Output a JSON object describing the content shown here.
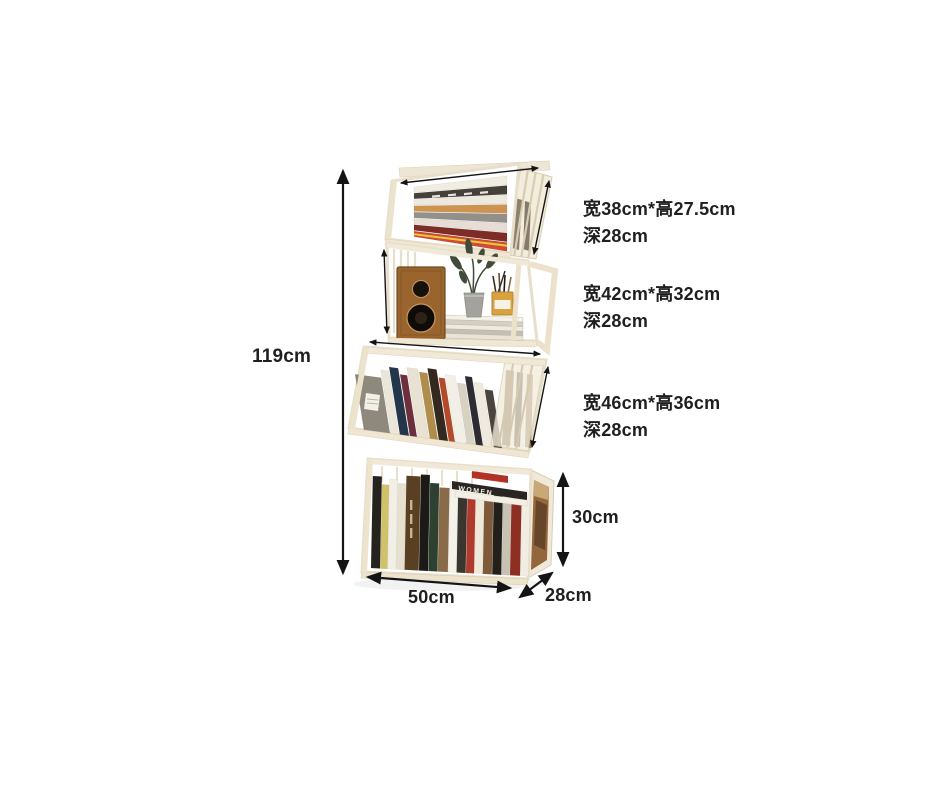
{
  "canvas": {
    "width": 940,
    "height": 788,
    "background": "#ffffff"
  },
  "labels": {
    "total_height": "119cm",
    "base_width": "50cm",
    "base_depth": "28cm",
    "tier4_height": "30cm",
    "tier_specs": [
      {
        "size": "宽38cm*高27.5cm",
        "depth": "深28cm"
      },
      {
        "size": "宽42cm*高32cm",
        "depth": "深28cm"
      },
      {
        "size": "宽46cm*高36cm",
        "depth": "深28cm"
      }
    ],
    "book_spine_text": "WOMEN"
  },
  "colors": {
    "text": "#1f1f1f",
    "arrow": "#141414",
    "crate_face": "#ffffff",
    "crate_wood": "#f1e9d7",
    "crate_edge": "#e8dfca",
    "speaker_wood": "#99642e",
    "pencil_cup": "#d8a33f",
    "plant_green": "#414b39",
    "side_artwork": "#94663c"
  },
  "illustration": {
    "tier1_flat_books": [
      "#f2ede1",
      "#45413a",
      "#eee9de",
      "#cf9350",
      "#93908a",
      "#e8dcd6",
      "#7e2d26",
      "#d14a33"
    ],
    "tier2_stack": [
      "#f4f1e9",
      "#d4cfc2",
      "#efeadf",
      "#c4bfb2",
      "#e9e4d7"
    ],
    "tier3_books": [
      [
        26,
        56,
        "#8f887c"
      ],
      [
        8,
        64,
        "#ece6d8"
      ],
      [
        9,
        68,
        "#24364a"
      ],
      [
        7,
        62,
        "#6d2f3c"
      ],
      [
        11,
        70,
        "#e9e2d2"
      ],
      [
        8,
        67,
        "#b08d4a"
      ],
      [
        9,
        72,
        "#33291f"
      ],
      [
        6,
        64,
        "#b44a2a"
      ],
      [
        10,
        68,
        "#f2efe7"
      ],
      [
        8,
        61,
        "#d8d2c2"
      ],
      [
        7,
        69,
        "#2e2b33"
      ],
      [
        9,
        64,
        "#efeadd"
      ],
      [
        8,
        58,
        "#4a443c"
      ]
    ],
    "tier4_books": [
      [
        9,
        92,
        "#26231f"
      ],
      [
        7,
        84,
        "#cfc268"
      ],
      [
        8,
        90,
        "#f2efe6"
      ],
      [
        8,
        86,
        "#e7e0cf"
      ],
      [
        14,
        94,
        "#5a4023"
      ],
      [
        9,
        96,
        "#1c1a17"
      ],
      [
        9,
        88,
        "#2e4030"
      ],
      [
        10,
        84,
        "#8a6b49"
      ],
      [
        8,
        90,
        "#f4f1e8"
      ],
      [
        9,
        80,
        "#3a352e"
      ],
      [
        8,
        78,
        "#b03a2c"
      ],
      [
        8,
        82,
        "#efe9da"
      ],
      [
        9,
        76,
        "#7e5a3a"
      ],
      [
        9,
        80,
        "#23201c"
      ],
      [
        8,
        74,
        "#c8c2b2"
      ],
      [
        10,
        78,
        "#8e2f24"
      ],
      [
        8,
        82,
        "#f1ede2"
      ]
    ]
  }
}
